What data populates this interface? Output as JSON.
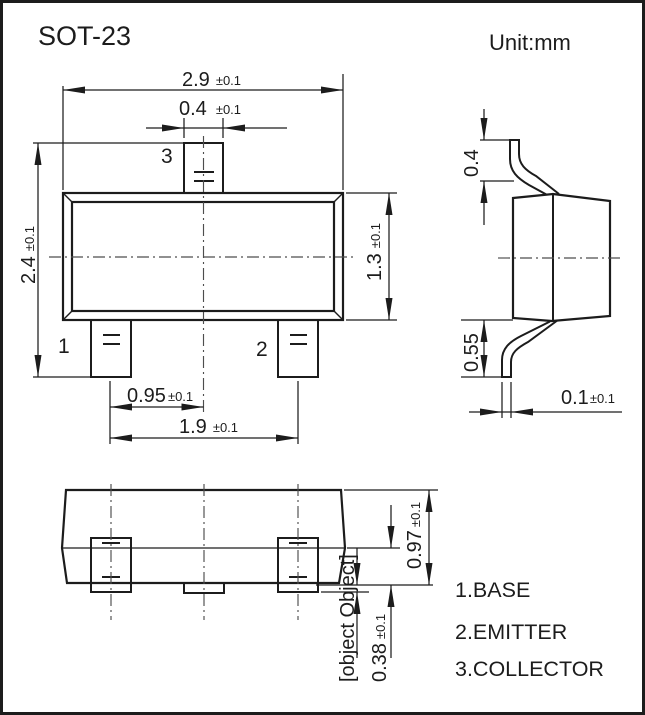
{
  "window": {
    "title": "SOT-23",
    "unit_label": "Unit:mm"
  },
  "front_view": {
    "pin1_label": "1",
    "pin2_label": "2",
    "pin3_label": "3",
    "dim_body_width": {
      "value": "2.9",
      "tolerance": "±0.1"
    },
    "dim_pin3_width": {
      "value": "0.4",
      "tolerance": "±0.1"
    },
    "dim_overall_height": {
      "value": "2.4",
      "tolerance": "±0.1"
    },
    "dim_body_height": {
      "value": "1.3",
      "tolerance": "±0.1"
    },
    "dim_pin_pitch": {
      "value": "0.95",
      "tolerance": "±0.1"
    },
    "dim_pin_span": {
      "value": "1.9",
      "tolerance": "±0.1"
    }
  },
  "side_view": {
    "dim_top_lead_height": {
      "value": "0.4"
    },
    "dim_bottom_lead_height": {
      "value": "0.55"
    },
    "dim_lead_thickness": {
      "value": "0.1",
      "tolerance": "±0.1"
    }
  },
  "bottom_view": {
    "dim_body_thickness": {
      "value": "0.97",
      "tolerance": "±0.1"
    },
    "dim_standoff": {
      "value": "0-0.1"
    },
    "dim_foot_height": {
      "value": "0.38",
      "tolerance": "±0.1"
    }
  },
  "legend": {
    "items": [
      {
        "label": "1.BASE"
      },
      {
        "label": "2.EMITTER"
      },
      {
        "label": "3.COLLECTOR"
      }
    ]
  },
  "colors": {
    "line": "#1c1c1c",
    "centerline": "#4d4d4d",
    "background": "#ffffff"
  }
}
